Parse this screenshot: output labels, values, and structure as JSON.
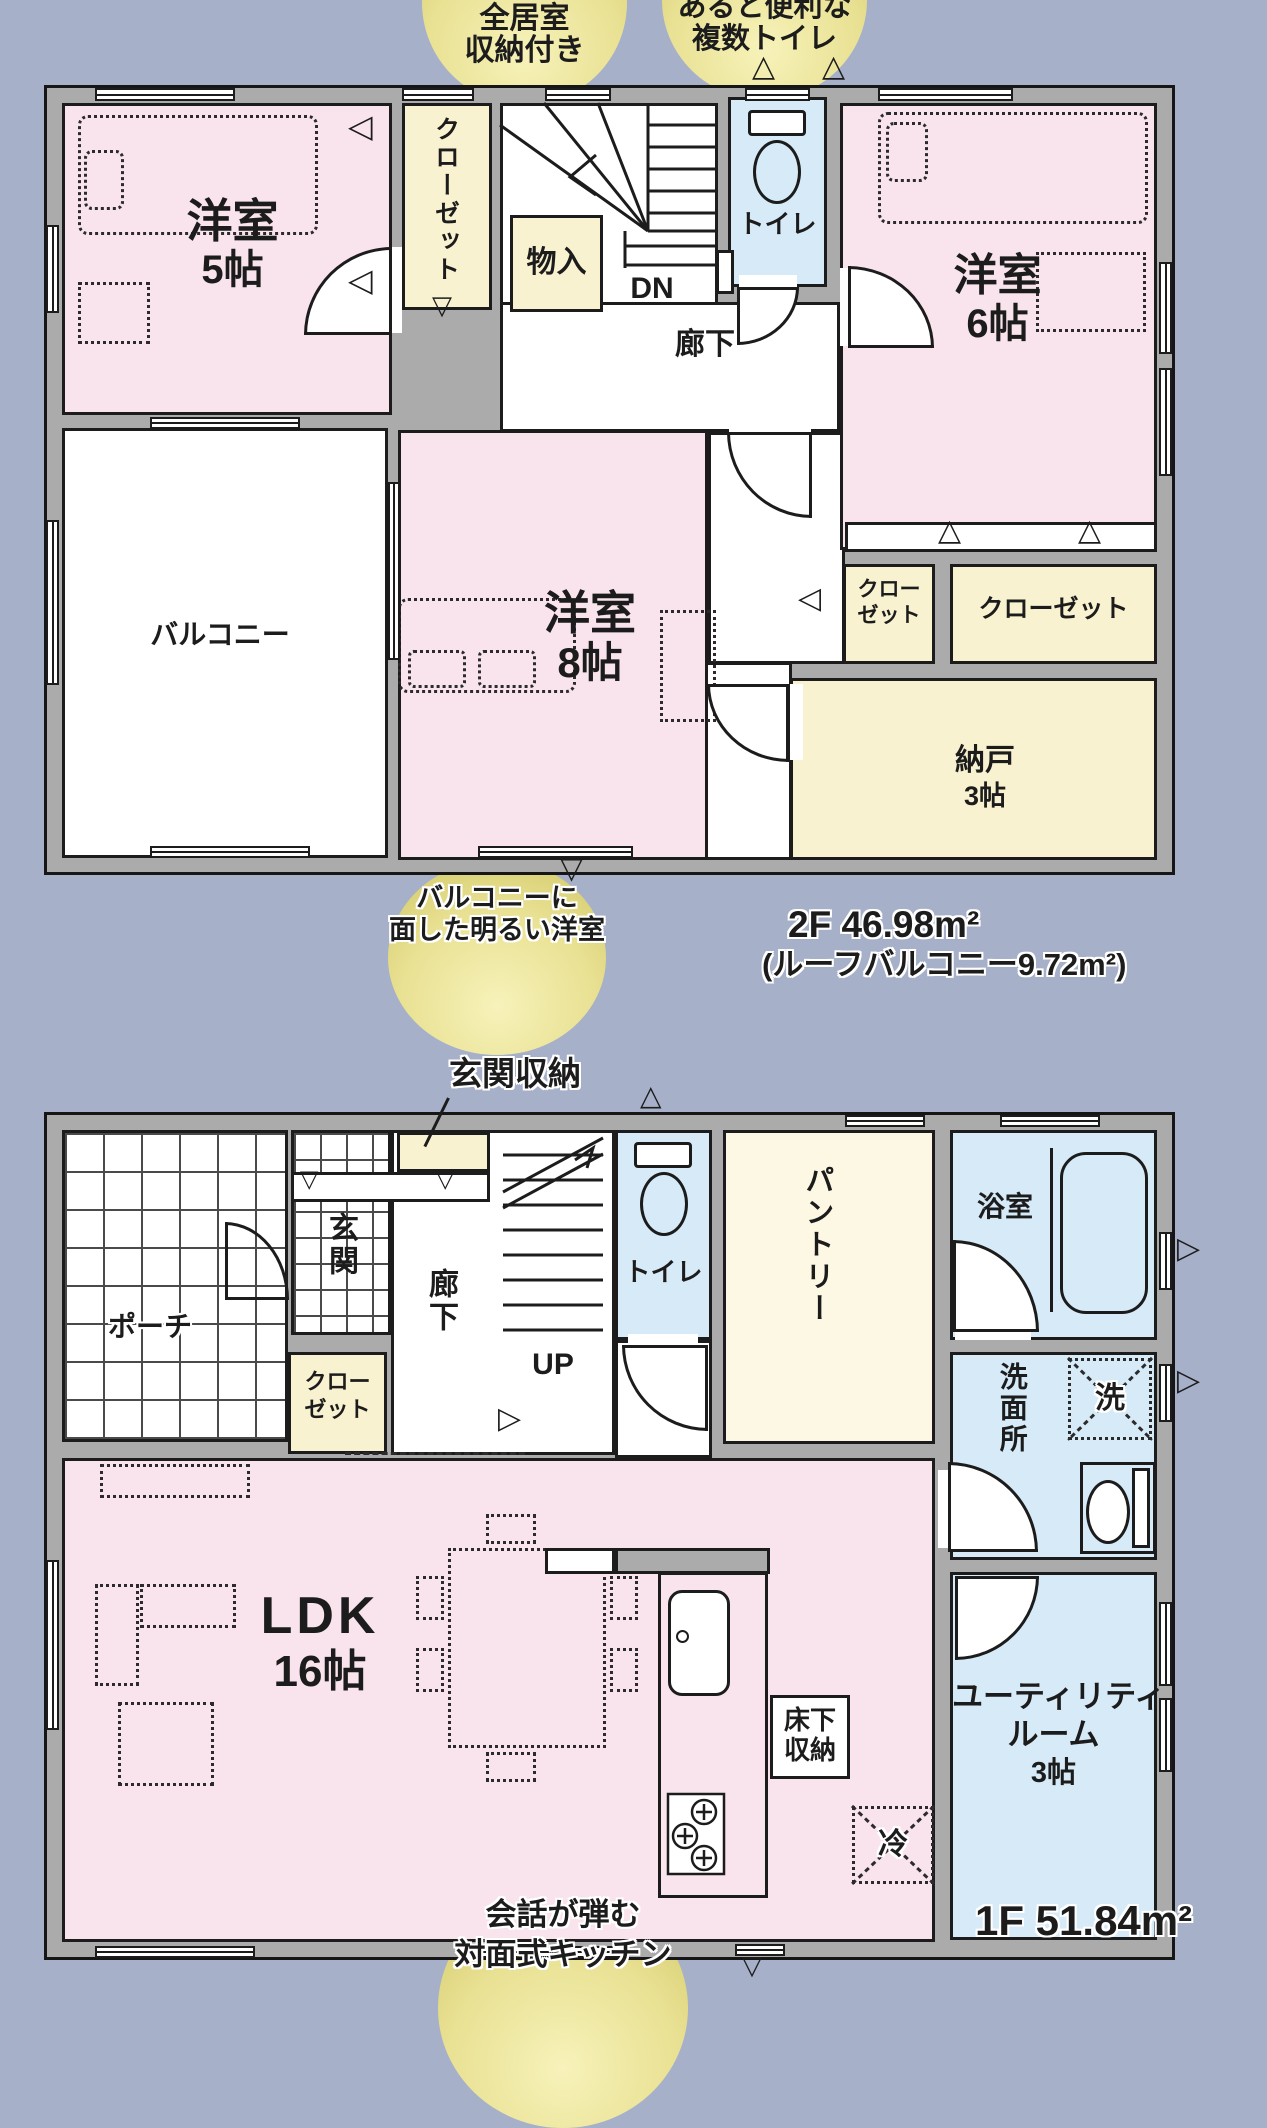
{
  "icons": {
    "tri_up": "△",
    "tri_down": "▽",
    "tri_left": "◁",
    "tri_right": "▷"
  },
  "badges": {
    "top_left": {
      "line1": "全居室",
      "line2": "収納付き"
    },
    "top_right": {
      "line1": "あると便利な",
      "line2": "複数トイレ"
    },
    "floor2": {
      "line1": "バルコニーに",
      "line2": "面した明るい洋室"
    },
    "floor1": {
      "line1": "会話が弾む",
      "line2": "対面式キッチン"
    }
  },
  "floor2": {
    "area": "2F 46.98m²",
    "area_note": "(ルーフバルコニー9.72m²)",
    "western5": {
      "title": "洋室",
      "size": "5帖"
    },
    "closet_left": "クローゼット",
    "storage": "物入",
    "dn": "DN",
    "toilet": "トイレ",
    "hallway": "廊下",
    "western6": {
      "title": "洋室",
      "size": "6帖"
    },
    "balcony": "バルコニー",
    "western8": {
      "title": "洋室",
      "size": "8帖"
    },
    "closet_small": {
      "line1": "クロー",
      "line2": "ゼット"
    },
    "closet_wide": "クローゼット",
    "nando": {
      "title": "納戸",
      "size": "3帖"
    }
  },
  "floor1": {
    "area": "1F 51.84m²",
    "note": "玄関収納",
    "porch": "ポーチ",
    "entrance": "玄関",
    "hallway": "廊下",
    "closet": {
      "line1": "クロー",
      "line2": "ゼット"
    },
    "up": "UP",
    "toilet": "トイレ",
    "pantry": "パントリー",
    "bath": "浴室",
    "washroom": "洗面所",
    "washer": "洗",
    "ldk": {
      "title": "LDK",
      "size": "16帖"
    },
    "floor_storage": {
      "line1": "床下",
      "line2": "収納"
    },
    "fridge": "冷",
    "utility": {
      "line1": "ユーティリティ",
      "line2": "ルーム",
      "line3": "3帖"
    }
  }
}
